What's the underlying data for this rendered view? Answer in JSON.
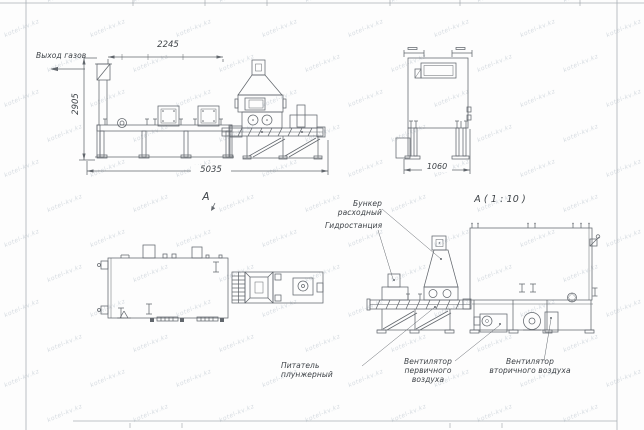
{
  "sheet": {
    "background": "#fdfdfd",
    "line_color": "#62676d",
    "text_color": "#3d4247",
    "frame_color": "#aab0b6",
    "watermark": {
      "text": "kotel-kv.kz",
      "color": "#ccd3da"
    }
  },
  "labels": {
    "gas_outlet": "Выход газов",
    "view_a": "А",
    "detail_a": "А ( 1 : 10 )",
    "feed_hopper": "Бункер расходный",
    "hydraulic_station": "Гидростанция",
    "plunger_feeder": "Питатель плунжерный",
    "primary_air_fan": "Вентилятор\nпервичного воздуха",
    "secondary_air_fan": "Вентилятор\nвторичного воздуха"
  },
  "dimensions": {
    "top_width": "2245",
    "height": "2905",
    "overall_length": "5035",
    "side_width": "1060"
  }
}
